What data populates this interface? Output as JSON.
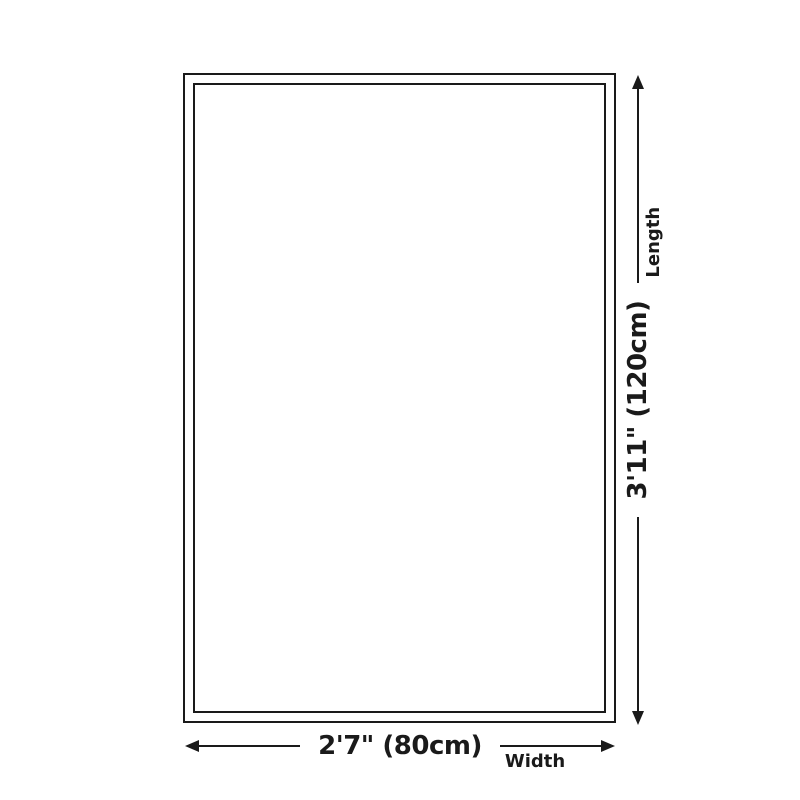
{
  "diagram": {
    "shape": "rectangle",
    "background_color": "#ffffff",
    "line_color": "#1a1a1a",
    "length": {
      "value": "3'11\" (120cm)",
      "label": "Length"
    },
    "width": {
      "value": "2'7\" (80cm)",
      "label": "Width"
    }
  }
}
